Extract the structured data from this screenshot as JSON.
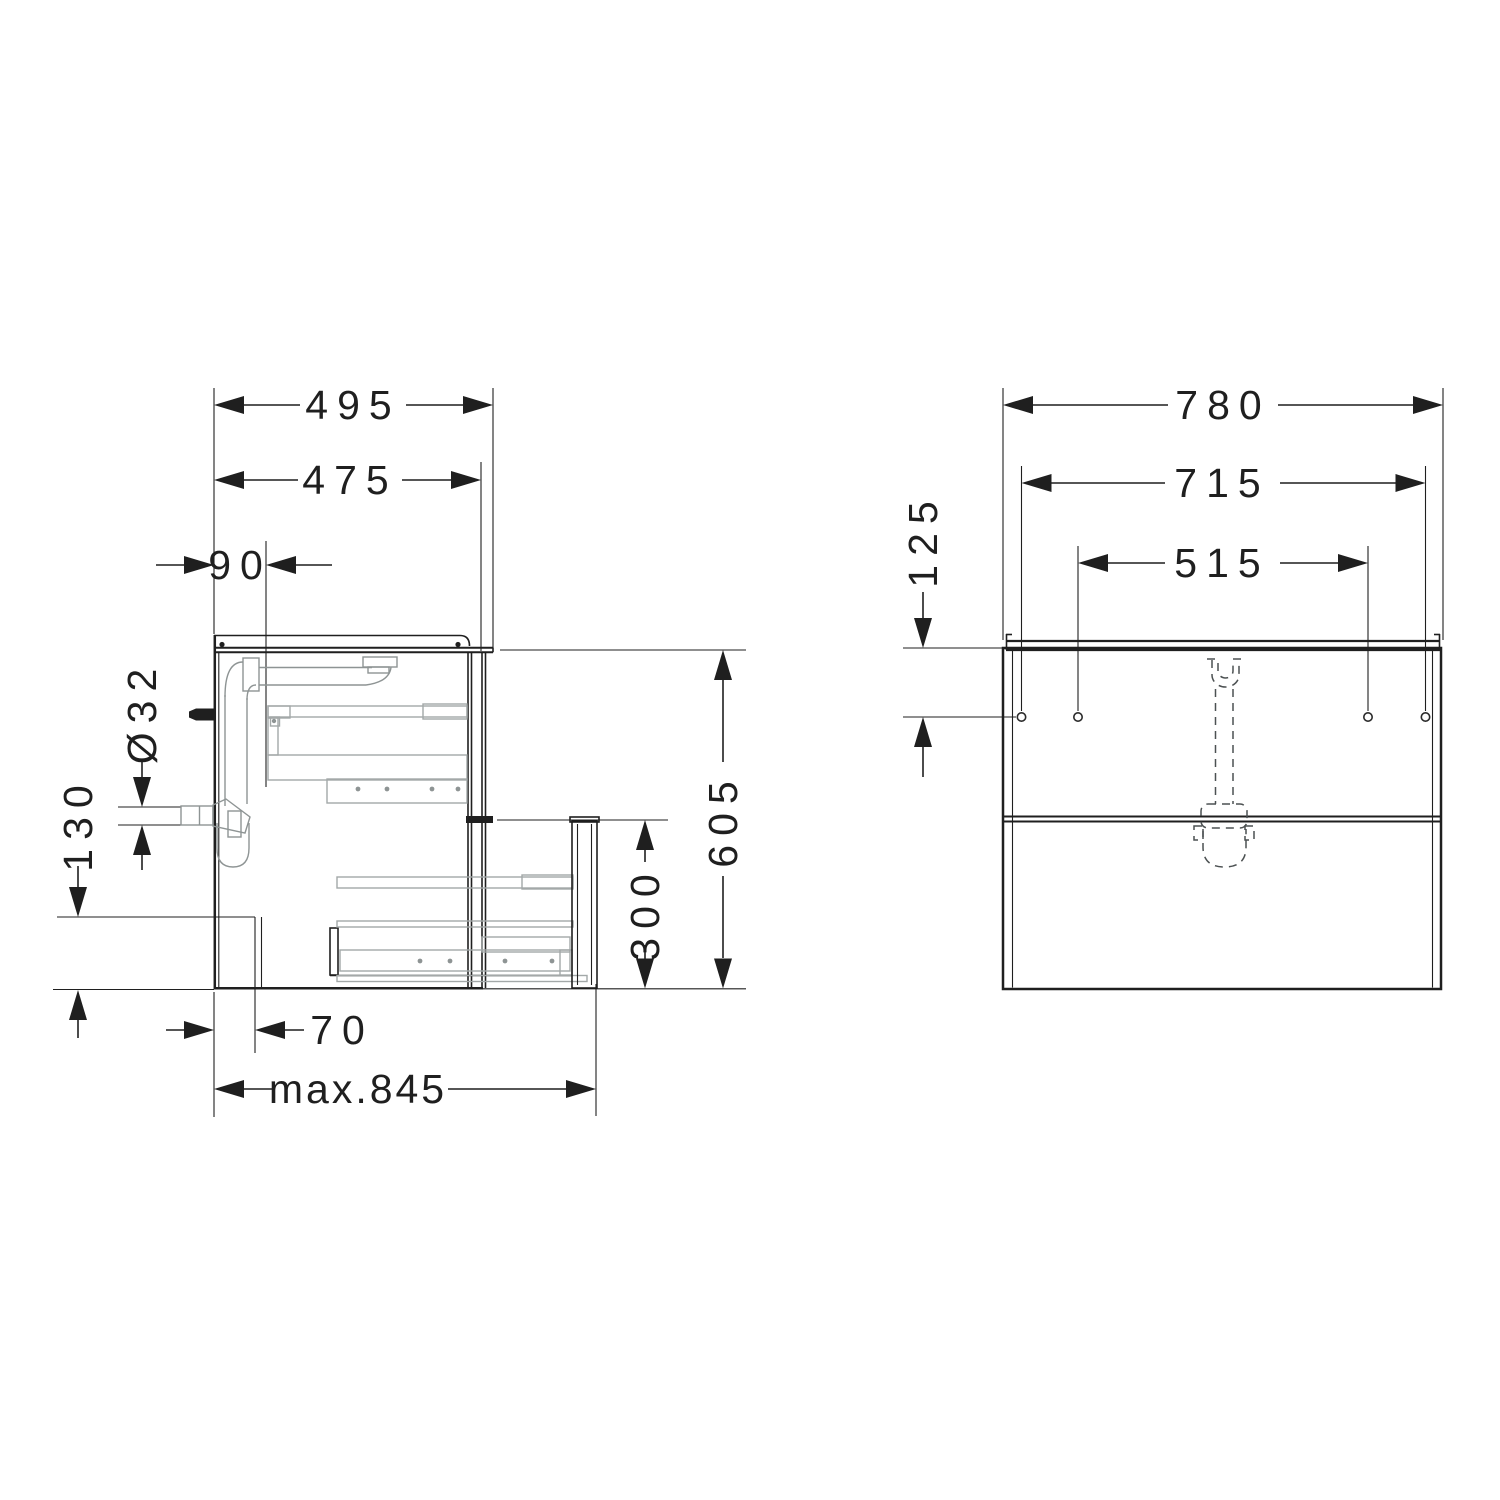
{
  "drawing": {
    "type": "technical installation drawing",
    "subject": "wash-basin vanity unit with two drawers",
    "background": "#ffffff",
    "ink_color": "#1f1f1f",
    "detail_color": "#a3a8a8",
    "dashed_color": "#4c5152",
    "side_view": {
      "name": "side section view",
      "dimensions": {
        "depth_total": "495",
        "depth_carcass": "475",
        "drain_offset_from_back": "90",
        "drain_pipe_diameter": "Ø32",
        "recess_height": "130",
        "height_total": "605",
        "lower_drawer_front_height": "300",
        "recess_depth": "70",
        "pullout_depth": "max.845"
      }
    },
    "front_view": {
      "name": "front view",
      "dimensions": {
        "width_total": "780",
        "mounting_holes_outer_spacing": "715",
        "mounting_holes_inner_spacing": "515",
        "mounting_holes_top_offset": "125"
      }
    }
  }
}
